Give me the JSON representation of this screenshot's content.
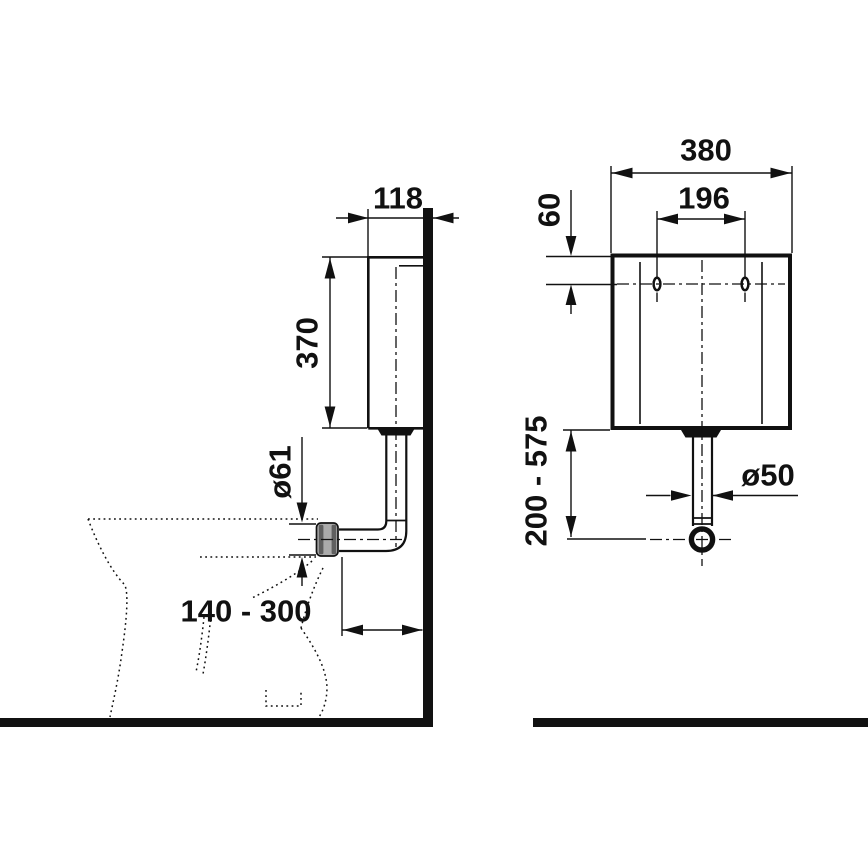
{
  "drawing": {
    "type": "technical-dimension-drawing",
    "subject": "wall-hung cistern with flush pipe and toilet outline, side view (left) and front view (right)",
    "units": "mm",
    "side_view": {
      "depth": "118",
      "height": "370",
      "connector_diameter": "ø61",
      "wall_to_flushpipe_range": "140 - 300"
    },
    "front_view": {
      "width": "380",
      "hole_spacing": "196",
      "top_to_holes": "60",
      "flushpipe_length_range": "200 - 575",
      "flushpipe_diameter": "ø50"
    },
    "colors": {
      "line": "#111111",
      "background": "#ffffff",
      "connector": "#ababab"
    }
  }
}
